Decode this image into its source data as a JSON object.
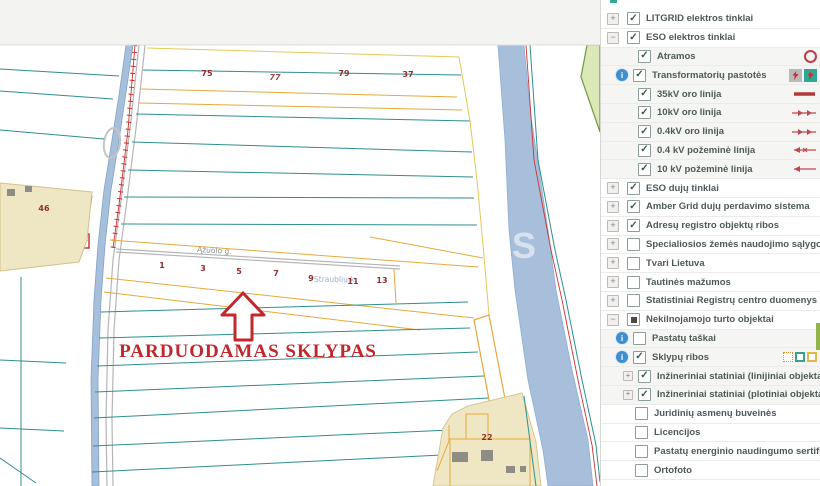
{
  "map": {
    "sale_label": "PARDUODAMAS SKLYPAS",
    "street_label": "Ąžuolo g.",
    "village_label": "Straublių k.",
    "watermark": "S",
    "parcel_numbers": {
      "top": [
        "75",
        "77",
        "79",
        "37"
      ],
      "left_village": "46",
      "street_row": [
        "1",
        "3",
        "5",
        "7",
        "9",
        "11",
        "13"
      ],
      "bottom_right": "22"
    },
    "colors": {
      "parcel_teal": "#2f8f8f",
      "parcel_orange": "#e5a93d",
      "water": "#a7bfdb",
      "sale_red": "#c1272d",
      "village_fill": "#efe7c3",
      "powerline_red": "#cc3333"
    }
  },
  "sidebar": {
    "layers": [
      {
        "label": "LITGRID elektros tinklai",
        "expand": "+",
        "checked": true
      },
      {
        "label": "ESO elektros tinklai",
        "expand": "-",
        "checked": true
      },
      {
        "label": "Atramos",
        "checked": true,
        "legend": "pole-circle"
      },
      {
        "label": "Transformatorių pastotės",
        "checked": true,
        "info": true,
        "legend": "transformer-squares"
      },
      {
        "label": "35kV oro linija",
        "checked": true,
        "legend": "thick-red-line"
      },
      {
        "label": "10kV oro linija",
        "checked": true,
        "legend": "red-line-right-arrows"
      },
      {
        "label": "0.4kV oro linija",
        "checked": true,
        "legend": "red-line-right-arrows"
      },
      {
        "label": "0.4 kV požeminė linija",
        "checked": true,
        "legend": "red-line-x-left-arrow"
      },
      {
        "label": "10 kV požeminė linija",
        "checked": true,
        "legend": "red-line-left-arrow"
      },
      {
        "label": "ESO dujų tinklai",
        "expand": "+",
        "checked": true
      },
      {
        "label": "Amber Grid dujų perdavimo sistema",
        "expand": "+",
        "checked": true
      },
      {
        "label": "Adresų registro objektų ribos",
        "expand": "+",
        "checked": true
      },
      {
        "label": "Specialiosios žemės naudojimo sąlygos",
        "expand": "+",
        "checked": false
      },
      {
        "label": "Tvari Lietuva",
        "expand": "+",
        "checked": false
      },
      {
        "label": "Tautinės mažumos",
        "expand": "+",
        "checked": false
      },
      {
        "label": "Statistiniai Registrų centro duomenys",
        "expand": "+",
        "checked": false
      },
      {
        "label": "Nekilnojamojo turto objektai",
        "expand": "-",
        "checked": "partial"
      },
      {
        "label": "Pastatų taškai",
        "checked": false,
        "info": true
      },
      {
        "label": "Sklypų ribos",
        "checked": true,
        "info": true,
        "legend": "parcel-squares"
      },
      {
        "label": "Inžineriniai statiniai (linijiniai objektai)",
        "expand": "+",
        "checked": true
      },
      {
        "label": "Inžineriniai statiniai (plotiniai objektai)",
        "expand": "+",
        "checked": true
      },
      {
        "label": "Juridinių asmenų buveinės",
        "checked": false
      },
      {
        "label": "Licencijos",
        "checked": false
      },
      {
        "label": "Pastatų energinio naudingumo sertifikatai",
        "checked": false
      },
      {
        "label": "Ortofoto",
        "checked": false
      }
    ]
  }
}
